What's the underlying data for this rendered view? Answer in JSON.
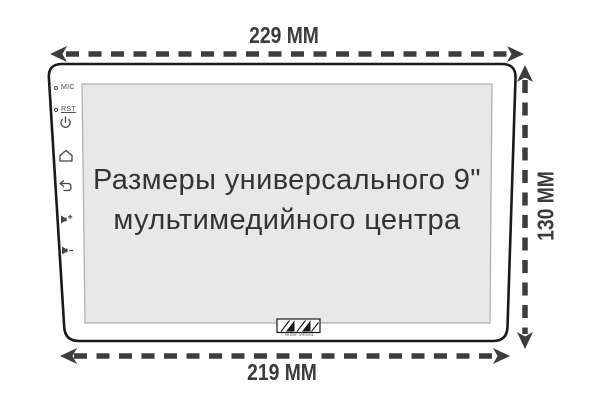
{
  "diagram": {
    "screen_title_line1": "Размеры универсального 9\"",
    "screen_title_line2": "мультимедийного центра"
  },
  "dimensions": {
    "top_width": "229 MM",
    "bottom_width": "219 MM",
    "side_height": "130 MM"
  },
  "device": {
    "buttons": [
      {
        "name": "mic",
        "label": "MIC"
      },
      {
        "name": "reset",
        "label": "RST"
      },
      {
        "name": "power",
        "icon": "power-icon"
      },
      {
        "name": "home",
        "icon": "home-icon"
      },
      {
        "name": "back",
        "icon": "back-arrow-icon"
      },
      {
        "name": "volume-up",
        "icon": "volume-plus-icon"
      },
      {
        "name": "volume-down",
        "icon": "volume-minus-icon"
      }
    ],
    "logo_text": "Wide Media"
  },
  "colors": {
    "arrow": "#3d3d3d",
    "device_outline": "#1a1a1a",
    "screen_fill": "#e8e8e8",
    "screen_border": "#adadad",
    "title_text": "#333333",
    "dim_text": "#3b3b3b"
  }
}
